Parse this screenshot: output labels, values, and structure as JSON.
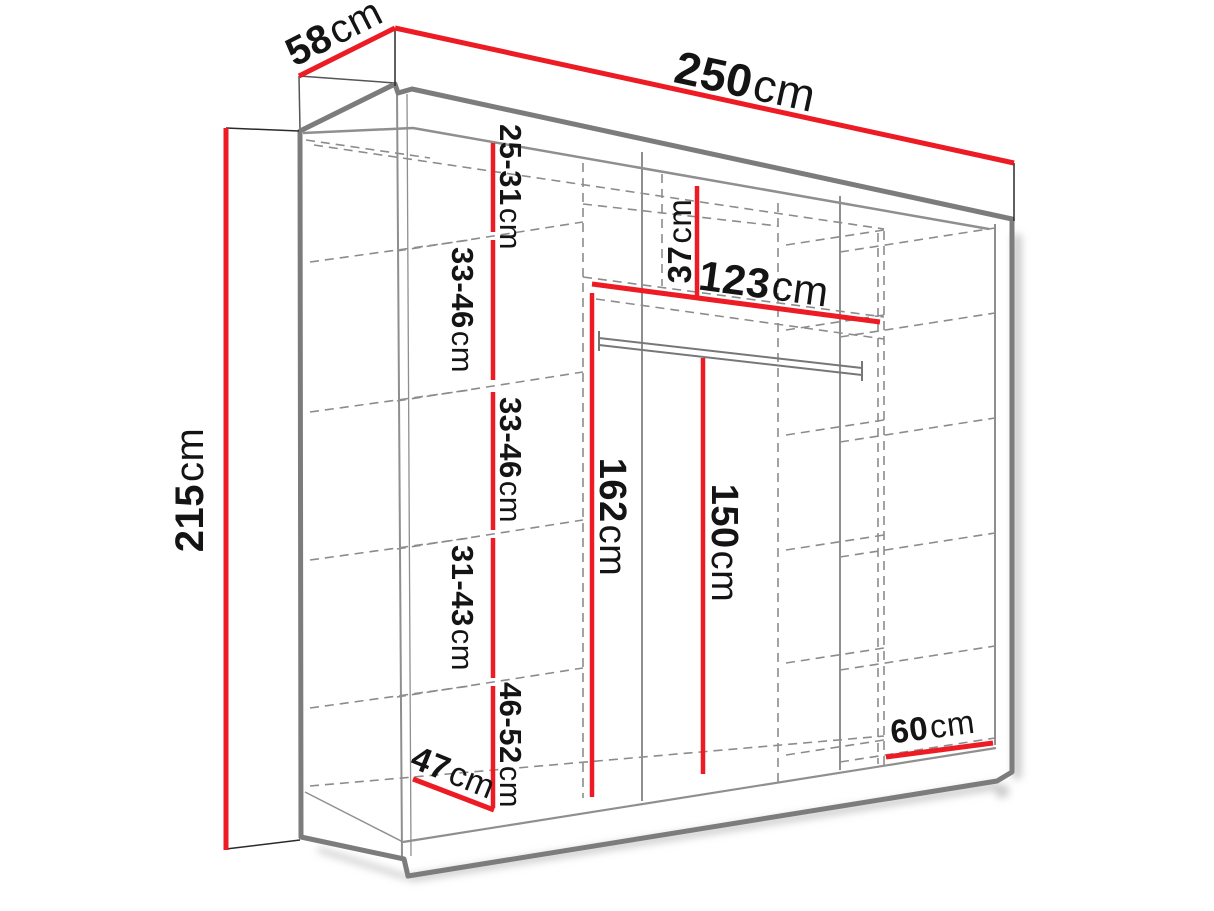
{
  "diagram": "wardrobe-dimension-drawing",
  "colors": {
    "dimension_red": "#ed1c24",
    "outline_grey": "#7c7c7c",
    "text": "#141414"
  },
  "d": {
    "width": {
      "value": "250",
      "unit": "cm"
    },
    "depth": {
      "value": "58",
      "unit": "cm"
    },
    "height": {
      "value": "215",
      "unit": "cm"
    },
    "gap1": {
      "value": "25-31",
      "unit": "cm"
    },
    "gap2": {
      "value": "33-46",
      "unit": "cm"
    },
    "gap3": {
      "value": "33-46",
      "unit": "cm"
    },
    "gap4": {
      "value": "31-43",
      "unit": "cm"
    },
    "gap5": {
      "value": "46-52",
      "unit": "cm"
    },
    "top_gap": {
      "value": "37",
      "unit": "cm"
    },
    "shelf_width": {
      "value": "123",
      "unit": "cm"
    },
    "hang_left": {
      "value": "162",
      "unit": "cm"
    },
    "hang_right": {
      "value": "150",
      "unit": "cm"
    },
    "bottom_left": {
      "value": "47",
      "unit": "cm"
    },
    "bottom_right": {
      "value": "60",
      "unit": "cm"
    }
  }
}
